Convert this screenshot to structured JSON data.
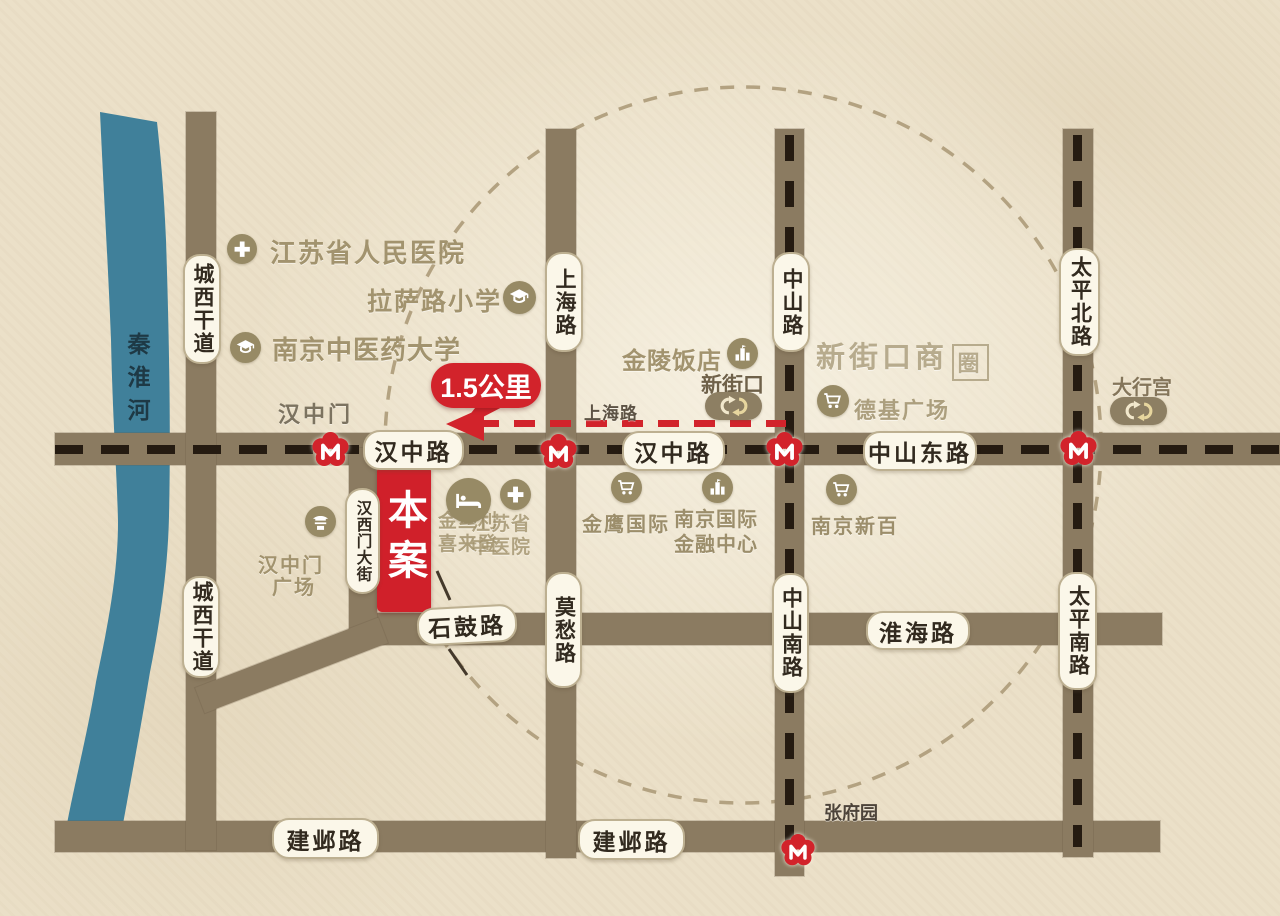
{
  "map": {
    "project_marker": "本案",
    "distance_label": "1.5公里",
    "river_name": "秦淮河",
    "road_labels": {
      "hanzhong_w": "汉中路",
      "hanzhong_e": "汉中路",
      "zhongshan_dong_lu": "中山东路",
      "shigu_lu": "石鼓路",
      "huaihai_lu": "淮海路",
      "jianye_w": "建邺路",
      "jianye_e": "建邺路",
      "chengxi_n": "城西干道",
      "chengxi_s": "城西干道",
      "shanghai_lu": "上海路",
      "mochou_lu": "莫愁路",
      "zhongshan_lu": "中山路",
      "zhongshan_nan_lu": "中山南路",
      "taiping_bei_lu": "太平北路",
      "taiping_nan_lu": "太平南路",
      "hanximen_dajie": "汉西门大街",
      "shanghai_lu_small": "上海路"
    },
    "stations": {
      "hanzhongmen": "汉中门",
      "xinjiekou": "新街口",
      "daxinggong": "大行宫",
      "zhangfuyuan": "张府园"
    },
    "pois": {
      "renmin_hospital": "江苏省人民医院",
      "lasa_school": "拉萨路小学",
      "zhongyiyao_univ": "南京中医药大学",
      "hanzhongmen_sq_1": "汉中门",
      "hanzhongmen_sq_2": "广场",
      "jinling_hotel": "金陵饭店",
      "business_circle_text": "新街口商",
      "business_circle_seal": "圈",
      "deji_plaza": "德基广场",
      "jinsili_1": "金丝利",
      "jinsili_2": "喜来登",
      "tcm_1": "江苏省",
      "tcm_2": "中医院",
      "jinying": "金鹰国际",
      "njifc_1": "南京国际",
      "njifc_2": "金融中心",
      "xinbai": "南京新百"
    },
    "colors": {
      "background": "#ebe0c8",
      "road": "#8b7b61",
      "river": "#40809a",
      "accent_red": "#d2232b",
      "metro_dash": "#251b11",
      "pill_bg": "#fbf7e9",
      "pill_border": "#bdb091",
      "poi_tan": "#a2936e"
    }
  }
}
